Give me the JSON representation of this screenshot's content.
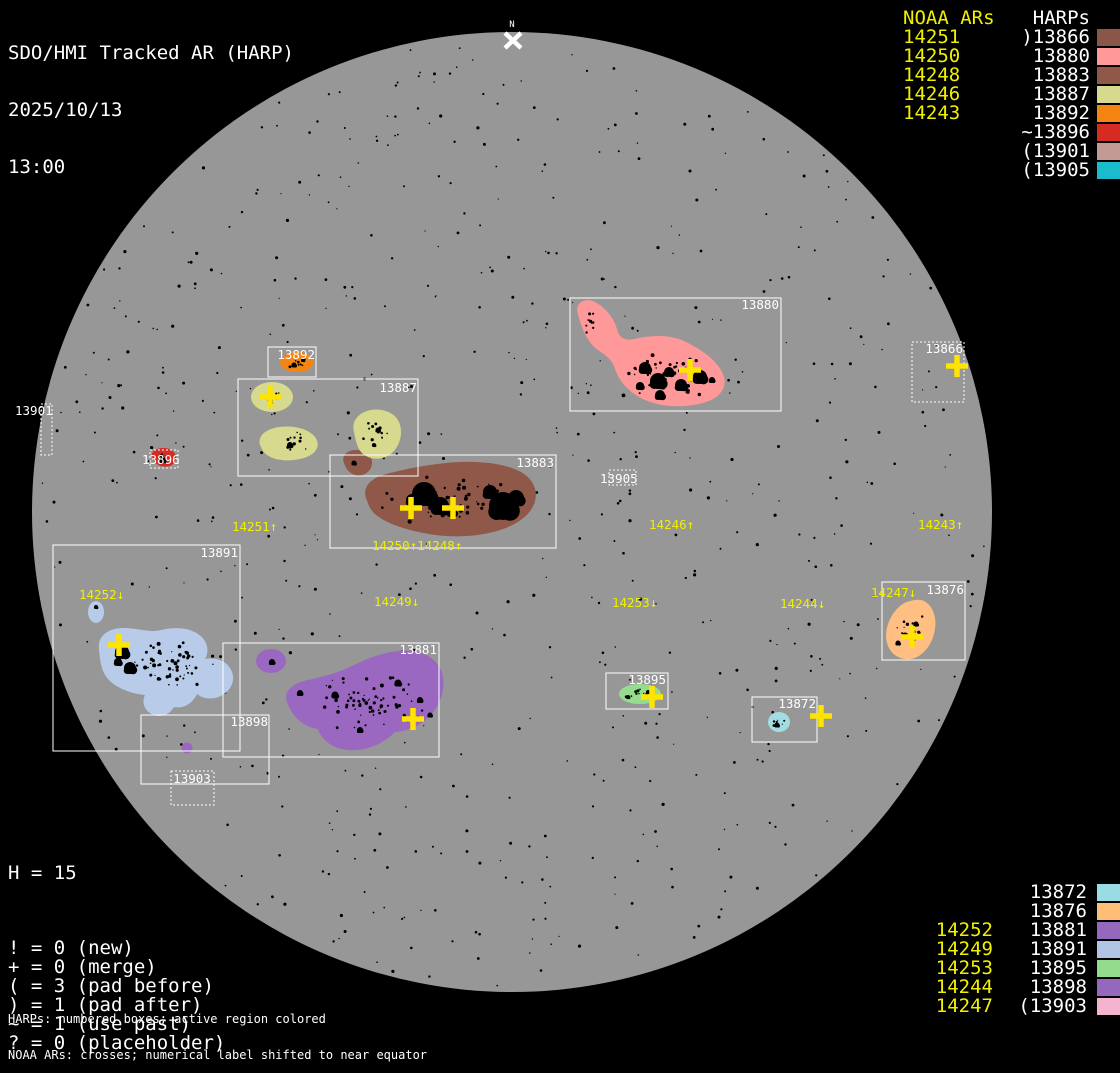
{
  "title": {
    "app": "SDO/HMI Tracked AR (HARP)",
    "date": "2025/10/13",
    "time": "13:00"
  },
  "north_marker": {
    "label": "N"
  },
  "legend_top_right": {
    "noaa_header": "NOAA ARs",
    "harp_header": "HARPs",
    "rows": [
      {
        "noaa": "14251",
        "harp": ")13866",
        "swatch": "#8a564a"
      },
      {
        "noaa": "14250",
        "harp": "13880",
        "swatch": "#ff9898"
      },
      {
        "noaa": "14248",
        "harp": "13883",
        "swatch": "#8f5848"
      },
      {
        "noaa": "14246",
        "harp": "13887",
        "swatch": "#d6d98e"
      },
      {
        "noaa": "14243",
        "harp": "13892",
        "swatch": "#f58513"
      },
      {
        "noaa": "",
        "harp": "~13896",
        "swatch": "#d62b23"
      },
      {
        "noaa": "",
        "harp": "(13901",
        "swatch": "#c49a94"
      },
      {
        "noaa": "",
        "harp": "(13905",
        "swatch": "#1abccc"
      }
    ]
  },
  "legend_bottom_right": {
    "rows": [
      {
        "noaa": "",
        "harp": "13872",
        "swatch": "#9adce4"
      },
      {
        "noaa": "",
        "harp": "13876",
        "swatch": "#ffbe78"
      },
      {
        "noaa": "14252",
        "harp": "13881",
        "swatch": "#9468bc"
      },
      {
        "noaa": "14249",
        "harp": "13891",
        "swatch": "#b0c4e4"
      },
      {
        "noaa": "14253",
        "harp": "13895",
        "swatch": "#94dc8c"
      },
      {
        "noaa": "14244",
        "harp": "13898",
        "swatch": "#9468bc"
      },
      {
        "noaa": "14247",
        "harp": "(13903",
        "swatch": "#f4b4d0"
      }
    ]
  },
  "stats": {
    "harp_count": "H = 15",
    "rows": [
      "! = 0 (new)",
      "+ = 0 (merge)",
      "( = 3 (pad before)",
      ") = 1 (pad after)",
      "~ = 1 (use past)",
      "? = 0 (placeholder)"
    ]
  },
  "footnotes": [
    "HARPs: numbered boxes; active region colored",
    "NOAA ARs: crosses; numerical label shifted to near equator"
  ],
  "chart_data": {
    "type": "scatter",
    "description": "Solar disk magnetogram overlay: HARP bounding boxes with colored active-region blobs, black sunspot umbrae, and yellow NOAA AR crosses/labels",
    "disk": {
      "cx": 512,
      "cy": 512,
      "r": 480,
      "color": "#979797"
    },
    "colors": {
      "background": "#000000",
      "box_stroke": "#ffffff",
      "noaa_text": "#f0f000",
      "cross": "#ffe400",
      "spot": "#000000"
    },
    "harp_boxes": [
      {
        "id": "13866",
        "x": 912,
        "y": 342,
        "w": 52,
        "h": 60,
        "dotted": true,
        "label_x": 963,
        "label_y": 353,
        "anchor": "end"
      },
      {
        "id": "13872",
        "x": 752,
        "y": 697,
        "w": 65,
        "h": 45,
        "dotted": false,
        "label_x": 816,
        "label_y": 708,
        "anchor": "end"
      },
      {
        "id": "13876",
        "x": 882,
        "y": 582,
        "w": 83,
        "h": 78,
        "dotted": false,
        "label_x": 964,
        "label_y": 594,
        "anchor": "end"
      },
      {
        "id": "13880",
        "x": 570,
        "y": 298,
        "w": 211,
        "h": 113,
        "dotted": false,
        "label_x": 779,
        "label_y": 309,
        "anchor": "end"
      },
      {
        "id": "13881",
        "x": 223,
        "y": 643,
        "w": 216,
        "h": 114,
        "dotted": false,
        "label_x": 437,
        "label_y": 654,
        "anchor": "end"
      },
      {
        "id": "13883",
        "x": 330,
        "y": 455,
        "w": 226,
        "h": 93,
        "dotted": false,
        "label_x": 554,
        "label_y": 467,
        "anchor": "end"
      },
      {
        "id": "13887",
        "x": 238,
        "y": 379,
        "w": 180,
        "h": 97,
        "dotted": false,
        "label_x": 417,
        "label_y": 392,
        "anchor": "end"
      },
      {
        "id": "13891",
        "x": 53,
        "y": 545,
        "w": 187,
        "h": 206,
        "dotted": false,
        "label_x": 238,
        "label_y": 557,
        "anchor": "end"
      },
      {
        "id": "13892",
        "x": 268,
        "y": 347,
        "w": 48,
        "h": 30,
        "dotted": false,
        "label_x": 315,
        "label_y": 359,
        "anchor": "end"
      },
      {
        "id": "13895",
        "x": 606,
        "y": 673,
        "w": 62,
        "h": 36,
        "dotted": false,
        "label_x": 666,
        "label_y": 684,
        "anchor": "end"
      },
      {
        "id": "13896",
        "x": 150,
        "y": 450,
        "w": 28,
        "h": 18,
        "dotted": true,
        "label_x": 142,
        "label_y": 464,
        "anchor": "start"
      },
      {
        "id": "13898",
        "x": 141,
        "y": 715,
        "w": 128,
        "h": 69,
        "dotted": false,
        "label_x": 268,
        "label_y": 726,
        "anchor": "end"
      },
      {
        "id": "13901",
        "x": 41,
        "y": 404,
        "w": 11,
        "h": 51,
        "dotted": true,
        "label_x": 15,
        "label_y": 415,
        "anchor": "start"
      },
      {
        "id": "13903",
        "x": 171,
        "y": 771,
        "w": 43,
        "h": 34,
        "dotted": true,
        "label_x": 192,
        "label_y": 783,
        "anchor": "middle"
      },
      {
        "id": "13905",
        "x": 609,
        "y": 470,
        "w": 27,
        "h": 15,
        "dotted": true,
        "label_x": 600,
        "label_y": 483,
        "anchor": "start"
      }
    ],
    "active_regions": [
      {
        "harp": "13880",
        "color": "#ff9898",
        "paths": [
          "M 578 314 C 574 303 585 297 595 302 C 606 308 614 318 617 329 C 619 338 625 341 634 339 C 652 335 672 334 688 343 C 704 351 718 362 723 374 C 728 386 721 397 706 402 C 688 408 663 408 645 400 C 629 393 619 381 615 369 C 612 359 605 355 598 350 C 588 343 581 328 578 314 Z"
        ],
        "ellipses": [],
        "umbrae": [
          [
            645,
            368,
            6
          ],
          [
            658,
            381,
            8
          ],
          [
            669,
            372,
            5
          ],
          [
            681,
            385,
            6
          ],
          [
            700,
            377,
            7
          ],
          [
            660,
            395,
            5
          ],
          [
            640,
            386,
            4
          ],
          [
            712,
            380,
            3
          ]
        ],
        "scatter": [
          {
            "cx": 665,
            "cy": 376,
            "sx": 46,
            "sy": 22,
            "n": 45,
            "rmin": 0.7,
            "rmax": 2.0
          },
          {
            "cx": 592,
            "cy": 322,
            "sx": 13,
            "sy": 13,
            "n": 10,
            "rmin": 0.7,
            "rmax": 1.8
          }
        ]
      },
      {
        "harp": "13883",
        "color": "#8f5848",
        "paths": [
          "M 366 498 C 362 486 372 477 390 473 C 410 468 436 463 460 462 C 484 461 506 464 521 472 C 533 479 538 490 535 501 C 532 513 520 523 503 529 C 483 536 458 538 436 535 C 414 532 392 526 379 517 C 370 511 369 506 366 498 Z",
          "M 344 463 C 341 456 347 450 356 450 C 365 450 373 456 372 464 C 371 472 363 477 355 475 C 349 473 346 469 344 463 Z"
        ],
        "ellipses": [],
        "umbrae": [
          [
            424,
            494,
            12
          ],
          [
            440,
            506,
            9
          ],
          [
            412,
            500,
            6
          ],
          [
            503,
            506,
            14
          ],
          [
            490,
            492,
            7
          ],
          [
            516,
            498,
            8
          ],
          [
            452,
            512,
            5
          ],
          [
            354,
            463,
            2.5
          ]
        ],
        "scatter": [
          {
            "cx": 450,
            "cy": 503,
            "sx": 70,
            "sy": 26,
            "n": 55,
            "rmin": 0.7,
            "rmax": 2.2
          }
        ]
      },
      {
        "harp": "13887",
        "color": "#d6d98e",
        "paths": [
          "M 261 447 C 256 438 264 429 279 427 C 294 425 309 429 315 437 C 321 445 317 454 304 458 C 291 462 275 461 267 455 C 262 451 263 451 261 447 Z",
          "M 354 432 C 351 421 359 412 371 410 C 383 408 395 413 399 422 C 403 431 401 443 394 451 C 387 459 375 461 366 456 C 357 451 356 441 354 432 Z"
        ],
        "ellipses": [
          [
            272,
            397,
            21,
            15
          ]
        ],
        "umbrae": [
          [
            270,
            399,
            2.5
          ],
          [
            290,
            445,
            3
          ],
          [
            378,
            430,
            2.5
          ],
          [
            374,
            445,
            2
          ]
        ],
        "scatter": [
          {
            "cx": 272,
            "cy": 398,
            "sx": 14,
            "sy": 9,
            "n": 8,
            "rmin": 0.6,
            "rmax": 1.6
          },
          {
            "cx": 288,
            "cy": 443,
            "sx": 20,
            "sy": 11,
            "n": 12,
            "rmin": 0.6,
            "rmax": 1.8
          },
          {
            "cx": 376,
            "cy": 433,
            "sx": 17,
            "sy": 16,
            "n": 12,
            "rmin": 0.6,
            "rmax": 1.8
          }
        ]
      },
      {
        "harp": "13892",
        "color": "#f58513",
        "paths": [],
        "ellipses": [
          [
            297,
            362,
            17,
            10
          ]
        ],
        "umbrae": [
          [
            294,
            365,
            2.5
          ],
          [
            303,
            360,
            2
          ]
        ],
        "scatter": [
          {
            "cx": 297,
            "cy": 362,
            "sx": 12,
            "sy": 6,
            "n": 8,
            "rmin": 0.6,
            "rmax": 1.6
          }
        ]
      },
      {
        "harp": "13896",
        "color": "#d62b23",
        "paths": [
          "M 152 456 C 151 451 157 448 164 448 C 171 448 177 453 176 459 C 175 465 168 468 161 466 C 155 464 153 461 152 456 Z"
        ],
        "ellipses": [],
        "umbrae": [
          [
            163,
            460,
            3
          ]
        ],
        "scatter": [
          {
            "cx": 163,
            "cy": 458,
            "sx": 8,
            "sy": 5,
            "n": 4,
            "rmin": 0.6,
            "rmax": 1.4
          }
        ]
      },
      {
        "harp": "13876",
        "color": "#ffbe82",
        "paths": [
          "M 915 600 C 925 598 933 606 935 618 C 937 632 931 648 919 656 C 907 663 893 658 888 646 C 883 634 888 617 899 607 C 904 602 909 601 915 600 Z"
        ],
        "ellipses": [],
        "umbrae": [
          [
            905,
            636,
            3.5
          ],
          [
            916,
            624,
            2.5
          ],
          [
            898,
            643,
            2.5
          ]
        ],
        "scatter": [
          {
            "cx": 910,
            "cy": 630,
            "sx": 16,
            "sy": 17,
            "n": 18,
            "rmin": 0.6,
            "rmax": 1.8
          }
        ]
      },
      {
        "harp": "13881",
        "color": "#9a68c0",
        "paths": [
          "M 287 702 C 283 691 293 683 308 680 C 322 677 338 673 354 665 C 372 656 394 649 412 651 C 429 653 441 663 443 677 C 445 691 440 705 431 715 C 422 725 408 731 395 732 C 383 744 365 752 347 750 C 331 748 321 739 318 729 C 304 727 292 717 287 702 Z"
        ],
        "ellipses": [
          [
            271,
            661,
            15,
            12
          ]
        ],
        "umbrae": [
          [
            335,
            695,
            3.5
          ],
          [
            300,
            693,
            3
          ],
          [
            398,
            683,
            3.5
          ],
          [
            420,
            700,
            3
          ],
          [
            360,
            730,
            3
          ],
          [
            430,
            715,
            2.5
          ],
          [
            272,
            662,
            3
          ]
        ],
        "scatter": [
          {
            "cx": 370,
            "cy": 703,
            "sx": 58,
            "sy": 28,
            "n": 70,
            "rmin": 0.6,
            "rmax": 2.0
          }
        ]
      },
      {
        "harp": "13898",
        "color": "#9a68c0",
        "paths": [],
        "ellipses": [
          [
            187,
            748,
            5.5,
            5.5
          ]
        ],
        "umbrae": [],
        "scatter": []
      },
      {
        "harp": "13891",
        "color": "#b8cbe9",
        "paths": [
          "M 99 650 C 97 636 108 628 124 628 C 138 628 150 633 161 630 C 173 627 188 627 198 634 C 207 640 210 650 205 659 C 214 657 225 660 230 668 C 236 677 233 688 224 694 C 216 700 204 700 197 694 C 193 703 184 709 174 707 C 170 714 162 718 154 715 C 145 712 141 703 145 695 C 133 694 117 689 108 679 C 101 671 100 660 99 650 Z"
        ],
        "ellipses": [
          [
            96,
            612,
            8,
            11
          ]
        ],
        "umbrae": [
          [
            122,
            652,
            7
          ],
          [
            130,
            668,
            6
          ],
          [
            118,
            662,
            4
          ],
          [
            96,
            607,
            2
          ]
        ],
        "scatter": [
          {
            "cx": 170,
            "cy": 665,
            "sx": 52,
            "sy": 28,
            "n": 60,
            "rmin": 0.6,
            "rmax": 2.0
          }
        ]
      },
      {
        "harp": "13895",
        "color": "#96dc8e",
        "paths": [],
        "ellipses": [
          [
            640,
            694,
            21,
            10
          ]
        ],
        "umbrae": [
          [
            628,
            697,
            2
          ],
          [
            648,
            692,
            2
          ]
        ],
        "scatter": [
          {
            "cx": 640,
            "cy": 694,
            "sx": 16,
            "sy": 6,
            "n": 10,
            "rmin": 0.6,
            "rmax": 1.6
          }
        ]
      },
      {
        "harp": "13872",
        "color": "#a3dce2",
        "paths": [],
        "ellipses": [
          [
            779,
            722,
            11,
            10
          ]
        ],
        "umbrae": [
          [
            777,
            725,
            2.5
          ]
        ],
        "scatter": [
          {
            "cx": 779,
            "cy": 722,
            "sx": 7,
            "sy": 6,
            "n": 6,
            "rmin": 0.6,
            "rmax": 1.4
          }
        ]
      }
    ],
    "noaa_crosses": [
      {
        "x": 690,
        "y": 370
      },
      {
        "x": 270,
        "y": 397
      },
      {
        "x": 411,
        "y": 508
      },
      {
        "x": 453,
        "y": 508
      },
      {
        "x": 957,
        "y": 366
      },
      {
        "x": 912,
        "y": 637
      },
      {
        "x": 119,
        "y": 645
      },
      {
        "x": 413,
        "y": 719
      },
      {
        "x": 652,
        "y": 697
      },
      {
        "x": 821,
        "y": 716
      }
    ],
    "noaa_labels": [
      {
        "text": "14251↑",
        "x": 232,
        "y": 531
      },
      {
        "text": "14250↑14248↑",
        "x": 372,
        "y": 550
      },
      {
        "text": "14252↓",
        "x": 79,
        "y": 599
      },
      {
        "text": "14249↓",
        "x": 374,
        "y": 606
      },
      {
        "text": "14253↓",
        "x": 612,
        "y": 607
      },
      {
        "text": "14244↓",
        "x": 780,
        "y": 608
      },
      {
        "text": "14246↑",
        "x": 649,
        "y": 529
      },
      {
        "text": "14243↑",
        "x": 918,
        "y": 529
      },
      {
        "text": "14247↓",
        "x": 871,
        "y": 597
      }
    ],
    "speckles": {
      "count": 680,
      "seed": 7
    }
  }
}
